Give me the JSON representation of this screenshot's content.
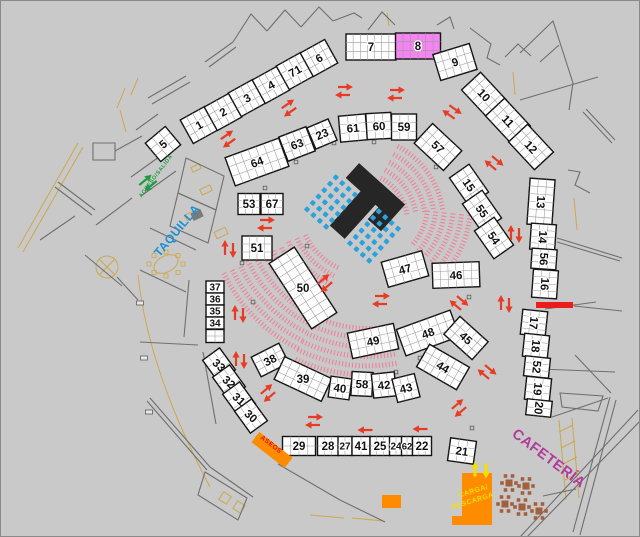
{
  "plan_title": "venue-floor-plan",
  "colors": {
    "bg": "#c9c9c9",
    "border": "#8a8a8a",
    "wall": "#6f6f6f",
    "tan": "#cda84e",
    "booth_fill": "#fdfdfd",
    "booth_stroke": "#141414",
    "grid": "#9b9b9b",
    "number": "#111111",
    "red": "#e83b23",
    "green": "#1f9b40",
    "chair_blue": "#2ba2dc",
    "hatch_pink": "#ef8198",
    "orange": "#ff8c00",
    "yellow": "#f3df00",
    "magenta": "#b23a9c",
    "taquilla_blue": "#1b8fd4",
    "stage_black": "#262626",
    "red_bar": "#ea1c1c",
    "table_brown": "#a2603f",
    "aseos_red": "#dd1111",
    "booth8_pink": "#f285ef"
  },
  "booths": [
    {
      "label": "5",
      "x": 163,
      "y": 144,
      "w": 26,
      "h": 24,
      "a": -40,
      "cols": 3,
      "rows": 3
    },
    {
      "label": "1",
      "x": 199,
      "y": 125,
      "w": 28,
      "h": 27,
      "a": -29,
      "cols": 4,
      "rows": 3
    },
    {
      "label": "2",
      "x": 223,
      "y": 112,
      "w": 28,
      "h": 27,
      "a": -29,
      "cols": 4,
      "rows": 3
    },
    {
      "label": "3",
      "x": 247,
      "y": 98,
      "w": 28,
      "h": 27,
      "a": -29,
      "cols": 4,
      "rows": 3
    },
    {
      "label": "4",
      "x": 271,
      "y": 85,
      "w": 28,
      "h": 27,
      "a": -29,
      "cols": 4,
      "rows": 3
    },
    {
      "label": "71",
      "x": 295,
      "y": 71,
      "w": 28,
      "h": 27,
      "a": -29,
      "cols": 4,
      "rows": 3
    },
    {
      "label": "6",
      "x": 319,
      "y": 58,
      "w": 28,
      "h": 27,
      "a": -29,
      "cols": 4,
      "rows": 3
    },
    {
      "label": "7",
      "x": 371,
      "y": 47,
      "w": 50,
      "h": 26,
      "a": 0,
      "cols": 7,
      "rows": 3
    },
    {
      "label": "8",
      "x": 418,
      "y": 46,
      "w": 45,
      "h": 26,
      "a": 0,
      "cols": 6,
      "rows": 3,
      "fill": "#f285ef"
    },
    {
      "label": "9",
      "x": 455,
      "y": 62,
      "w": 38,
      "h": 27,
      "a": -17,
      "cols": 5,
      "rows": 3
    },
    {
      "label": "10",
      "x": 484,
      "y": 95,
      "w": 38,
      "h": 26,
      "a": 47,
      "cols": 5,
      "rows": 3
    },
    {
      "label": "11",
      "x": 508,
      "y": 121,
      "w": 38,
      "h": 26,
      "a": 47,
      "cols": 5,
      "rows": 3
    },
    {
      "label": "12",
      "x": 531,
      "y": 147,
      "w": 38,
      "h": 26,
      "a": 47,
      "cols": 5,
      "rows": 3
    },
    {
      "label": "13",
      "x": 541,
      "y": 202,
      "w": 25,
      "h": 46,
      "a": 4,
      "cols": 3,
      "rows": 6,
      "lr": 90
    },
    {
      "label": "14",
      "x": 543,
      "y": 237,
      "w": 25,
      "h": 26,
      "a": 4,
      "cols": 3,
      "rows": 4,
      "lr": 90
    },
    {
      "label": "56",
      "x": 544,
      "y": 259,
      "w": 25,
      "h": 20,
      "a": 4,
      "cols": 3,
      "rows": 3,
      "lr": 90
    },
    {
      "label": "16",
      "x": 545,
      "y": 284,
      "w": 25,
      "h": 28,
      "a": 4,
      "cols": 3,
      "rows": 4,
      "lr": 90
    },
    {
      "label": "17",
      "x": 534,
      "y": 323,
      "w": 25,
      "h": 25,
      "a": 6,
      "cols": 3,
      "rows": 4,
      "lr": 90
    },
    {
      "label": "18",
      "x": 536,
      "y": 346,
      "w": 25,
      "h": 23,
      "a": 6,
      "cols": 3,
      "rows": 3,
      "lr": 90
    },
    {
      "label": "52",
      "x": 537,
      "y": 367,
      "w": 25,
      "h": 20,
      "a": 6,
      "cols": 3,
      "rows": 3,
      "lr": 90
    },
    {
      "label": "19",
      "x": 538,
      "y": 389,
      "w": 25,
      "h": 23,
      "a": 6,
      "cols": 3,
      "rows": 3,
      "lr": 90
    },
    {
      "label": "20",
      "x": 539,
      "y": 408,
      "w": 25,
      "h": 16,
      "a": 6,
      "cols": 3,
      "rows": 2,
      "lr": 90
    },
    {
      "label": "64",
      "x": 257,
      "y": 162,
      "w": 57,
      "h": 30,
      "a": -20,
      "cols": 7,
      "rows": 3
    },
    {
      "label": "63",
      "x": 297,
      "y": 144,
      "w": 29,
      "h": 26,
      "a": -21,
      "cols": 4,
      "rows": 3
    },
    {
      "label": "23",
      "x": 322,
      "y": 134,
      "w": 23,
      "h": 23,
      "a": -23,
      "cols": 3,
      "rows": 3
    },
    {
      "label": "61",
      "x": 353,
      "y": 128,
      "w": 27,
      "h": 26,
      "a": -5,
      "cols": 3,
      "rows": 3
    },
    {
      "label": "60",
      "x": 379,
      "y": 126,
      "w": 25,
      "h": 26,
      "a": -3,
      "cols": 3,
      "rows": 3
    },
    {
      "label": "59",
      "x": 404,
      "y": 127,
      "w": 25,
      "h": 26,
      "a": 0,
      "cols": 3,
      "rows": 3
    },
    {
      "label": "57",
      "x": 438,
      "y": 147,
      "w": 40,
      "h": 27,
      "a": 43,
      "cols": 5,
      "rows": 3
    },
    {
      "label": "15",
      "x": 469,
      "y": 185,
      "w": 34,
      "h": 24,
      "a": 55,
      "cols": 4,
      "rows": 3
    },
    {
      "label": "55",
      "x": 482,
      "y": 211,
      "w": 34,
      "h": 24,
      "a": 55,
      "cols": 4,
      "rows": 3
    },
    {
      "label": "54",
      "x": 494,
      "y": 238,
      "w": 34,
      "h": 24,
      "a": 55,
      "cols": 4,
      "rows": 3
    },
    {
      "label": "53",
      "x": 249,
      "y": 204,
      "w": 22,
      "h": 21,
      "a": 0,
      "cols": 3,
      "rows": 3
    },
    {
      "label": "67",
      "x": 272,
      "y": 204,
      "w": 22,
      "h": 21,
      "a": 0,
      "cols": 3,
      "rows": 3
    },
    {
      "label": "51",
      "x": 257,
      "y": 248,
      "w": 30,
      "h": 24,
      "a": 0,
      "cols": 4,
      "rows": 3
    },
    {
      "label": "50",
      "x": 303,
      "y": 288,
      "w": 78,
      "h": 30,
      "a": 57,
      "cols": 9,
      "rows": 3,
      "lr": -57
    },
    {
      "label": "47",
      "x": 405,
      "y": 269,
      "w": 42,
      "h": 26,
      "a": -16,
      "cols": 5,
      "rows": 3
    },
    {
      "label": "46",
      "x": 456,
      "y": 275,
      "w": 47,
      "h": 25,
      "a": -2,
      "cols": 6,
      "rows": 3
    },
    {
      "label": "48",
      "x": 428,
      "y": 333,
      "w": 57,
      "h": 28,
      "a": -20,
      "cols": 7,
      "rows": 3
    },
    {
      "label": "45",
      "x": 466,
      "y": 338,
      "w": 38,
      "h": 24,
      "a": 42,
      "cols": 5,
      "rows": 3
    },
    {
      "label": "44",
      "x": 443,
      "y": 367,
      "w": 46,
      "h": 26,
      "a": 30,
      "cols": 6,
      "rows": 3
    },
    {
      "label": "49",
      "x": 373,
      "y": 341,
      "w": 47,
      "h": 26,
      "a": -12,
      "cols": 6,
      "rows": 3
    },
    {
      "label": "38",
      "x": 270,
      "y": 360,
      "w": 31,
      "h": 22,
      "a": -27,
      "cols": 4,
      "rows": 3
    },
    {
      "label": "39",
      "x": 303,
      "y": 379,
      "w": 52,
      "h": 25,
      "a": 25,
      "cols": 6,
      "rows": 3,
      "lr": -25
    },
    {
      "label": "40",
      "x": 340,
      "y": 388,
      "w": 21,
      "h": 21,
      "a": 8,
      "cols": 3,
      "rows": 3
    },
    {
      "label": "58",
      "x": 362,
      "y": 384,
      "w": 21,
      "h": 24,
      "a": 3,
      "cols": 3,
      "rows": 3
    },
    {
      "label": "42",
      "x": 384,
      "y": 385,
      "w": 23,
      "h": 24,
      "a": -6,
      "cols": 3,
      "rows": 3
    },
    {
      "label": "43",
      "x": 406,
      "y": 388,
      "w": 23,
      "h": 24,
      "a": -14,
      "cols": 3,
      "rows": 3
    },
    {
      "label": "37",
      "x": 215,
      "y": 287,
      "w": 18,
      "h": 12,
      "a": 0,
      "cols": 2,
      "rows": 1,
      "fs": 10
    },
    {
      "label": "36",
      "x": 215,
      "y": 299,
      "w": 18,
      "h": 12,
      "a": 0,
      "cols": 2,
      "rows": 1,
      "fs": 10
    },
    {
      "label": "35",
      "x": 215,
      "y": 311,
      "w": 18,
      "h": 12,
      "a": 0,
      "cols": 2,
      "rows": 1,
      "fs": 10
    },
    {
      "label": "34",
      "x": 215,
      "y": 323,
      "w": 18,
      "h": 12,
      "a": 0,
      "cols": 2,
      "rows": 1,
      "fs": 10
    },
    {
      "label": "",
      "x": 215,
      "y": 336,
      "w": 18,
      "h": 13,
      "a": 0,
      "cols": 2,
      "rows": 2
    },
    {
      "label": "33",
      "x": 219,
      "y": 365,
      "w": 27,
      "h": 21,
      "a": 54,
      "cols": 3,
      "rows": 3,
      "lr": -12
    },
    {
      "label": "32",
      "x": 229,
      "y": 382,
      "w": 27,
      "h": 21,
      "a": 54,
      "cols": 3,
      "rows": 3,
      "lr": -12
    },
    {
      "label": "31",
      "x": 239,
      "y": 399,
      "w": 27,
      "h": 21,
      "a": 54,
      "cols": 3,
      "rows": 3,
      "lr": -12
    },
    {
      "label": "30",
      "x": 251,
      "y": 416,
      "w": 27,
      "h": 21,
      "a": 54,
      "cols": 3,
      "rows": 3,
      "lr": -12
    },
    {
      "label": "29",
      "x": 299,
      "y": 446,
      "w": 33,
      "h": 19,
      "a": 0,
      "cols": 4,
      "rows": 2
    },
    {
      "label": "28",
      "x": 328,
      "y": 446,
      "w": 21,
      "h": 19,
      "a": 0,
      "cols": 3,
      "rows": 2
    },
    {
      "label": "27",
      "x": 345,
      "y": 446,
      "w": 14,
      "h": 19,
      "a": 0,
      "cols": 2,
      "rows": 2,
      "fs": 10
    },
    {
      "label": "41",
      "x": 361,
      "y": 446,
      "w": 18,
      "h": 19,
      "a": 0,
      "cols": 2,
      "rows": 2
    },
    {
      "label": "25",
      "x": 380,
      "y": 446,
      "w": 20,
      "h": 19,
      "a": 0,
      "cols": 3,
      "rows": 2
    },
    {
      "label": "24",
      "x": 396,
      "y": 446,
      "w": 13,
      "h": 19,
      "a": 0,
      "cols": 2,
      "rows": 2,
      "fs": 10
    },
    {
      "label": "62",
      "x": 407,
      "y": 446,
      "w": 11,
      "h": 19,
      "a": 0,
      "cols": 2,
      "rows": 2,
      "fs": 9.5
    },
    {
      "label": "22",
      "x": 422,
      "y": 446,
      "w": 19,
      "h": 19,
      "a": 0,
      "cols": 3,
      "rows": 2
    },
    {
      "label": "21",
      "x": 462,
      "y": 451,
      "w": 26,
      "h": 23,
      "a": 8,
      "cols": 3,
      "rows": 3
    }
  ],
  "zone_labels": [
    {
      "id": "acceso",
      "text": "ACCESO/SALIDA",
      "x": 157,
      "y": 177,
      "a": -53,
      "size": 5.5,
      "color": "#1f9b40"
    },
    {
      "id": "taquilla",
      "text": "TAQUILLA",
      "x": 180,
      "y": 233,
      "a": -50,
      "size": 12,
      "color": "#1b8fd4"
    },
    {
      "id": "aseos",
      "text": "ASEOS",
      "x": 270,
      "y": 446,
      "a": 38,
      "size": 6.5,
      "color": "#dd1111"
    },
    {
      "id": "cafeteria",
      "text": "CAFETERÍA",
      "x": 546,
      "y": 462,
      "a": 37,
      "size": 14.5,
      "color": "#b23a9c"
    },
    {
      "id": "carga-line1",
      "text": "CARGA/",
      "x": 474,
      "y": 493,
      "a": -17,
      "size": 7,
      "color": "#f3df00"
    },
    {
      "id": "carga-line2",
      "text": "DESCARGA",
      "x": 473,
      "y": 503,
      "a": -17,
      "size": 7,
      "color": "#f3df00"
    }
  ],
  "stage": {
    "cx": 368,
    "cy": 198,
    "a": 42,
    "points": "-30,-20 32,-20 32,16 14,16 14,0 10,0 10,46 -10,46 -10,0 -30,0"
  },
  "chair_blocks": [
    {
      "cx": 331,
      "cy": 202,
      "a": 42,
      "cols": 4,
      "rows": 6,
      "pitch": 8.6,
      "size": 4.6
    },
    {
      "cx": 374,
      "cy": 236,
      "a": 42,
      "cols": 4,
      "rows": 6,
      "pitch": 8.6,
      "size": 4.6
    }
  ],
  "hatch_clusters": [
    {
      "cx": 358,
      "cy": 222,
      "r0": 52,
      "r1": 88,
      "a0": -62,
      "a1": -8
    },
    {
      "cx": 368,
      "cy": 205,
      "r0": 62,
      "r1": 105,
      "a0": 6,
      "a1": 42
    },
    {
      "cx": 368,
      "cy": 205,
      "r0": 72,
      "r1": 162,
      "a0": 116,
      "a1": 155
    },
    {
      "cx": 368,
      "cy": 205,
      "r0": 126,
      "r1": 182,
      "a0": 80,
      "a1": 116
    }
  ],
  "arrow_pairs_red": [
    {
      "x": 228,
      "y": 139,
      "a": 35
    },
    {
      "x": 289,
      "y": 108,
      "a": 35
    },
    {
      "x": 344,
      "y": 91,
      "a": 0
    },
    {
      "x": 396,
      "y": 94,
      "a": 0
    },
    {
      "x": 452,
      "y": 112,
      "a": -35
    },
    {
      "x": 494,
      "y": 163,
      "a": -40
    },
    {
      "x": 515,
      "y": 234,
      "a": 90
    },
    {
      "x": 266,
      "y": 224,
      "a": 0
    },
    {
      "x": 229,
      "y": 249,
      "a": 90
    },
    {
      "x": 239,
      "y": 314,
      "a": 90
    },
    {
      "x": 240,
      "y": 360,
      "a": 90
    },
    {
      "x": 268,
      "y": 393,
      "a": 40
    },
    {
      "x": 314,
      "y": 421,
      "a": 0
    },
    {
      "x": 325,
      "y": 283,
      "a": 40
    },
    {
      "x": 381,
      "y": 300,
      "a": 0
    },
    {
      "x": 459,
      "y": 303,
      "a": -40
    },
    {
      "x": 505,
      "y": 304,
      "a": 90
    },
    {
      "x": 487,
      "y": 372,
      "a": -40
    },
    {
      "x": 459,
      "y": 408,
      "a": 40
    }
  ],
  "arrows_red_single": [
    {
      "x": 365,
      "y": 430,
      "a": 180
    },
    {
      "x": 420,
      "y": 429,
      "a": 180
    }
  ],
  "arrow_pair_green": {
    "x": 148,
    "y": 183,
    "a": 40
  },
  "arrows_yellow": [
    {
      "x": 475,
      "y": 469,
      "a": 90
    },
    {
      "x": 486,
      "y": 471,
      "a": 270
    }
  ],
  "orange_areas": {
    "aseos_bar": {
      "cx": 272,
      "cy": 450,
      "w": 42,
      "h": 13,
      "a": 38
    },
    "carga_polygon": "462,473 492,473 492,525 452,525 452,516 462,516",
    "small_rect": {
      "x": 382,
      "y": 495,
      "w": 19,
      "h": 13
    }
  },
  "red_bar": {
    "x": 536,
    "y": 302,
    "w": 37,
    "h": 6
  },
  "cafe_tables": [
    {
      "x": 509,
      "y": 483
    },
    {
      "x": 526,
      "y": 486
    },
    {
      "x": 505,
      "y": 504
    },
    {
      "x": 522,
      "y": 507
    },
    {
      "x": 539,
      "y": 511
    }
  ],
  "columns": [
    [
      265,
      188
    ],
    [
      296,
      162
    ],
    [
      334,
      143
    ],
    [
      374,
      142
    ],
    [
      436,
      167
    ],
    [
      469,
      297
    ],
    [
      420,
      358
    ],
    [
      242,
      263
    ],
    [
      253,
      302
    ],
    [
      472,
      428
    ],
    [
      307,
      246
    ],
    [
      396,
      372
    ]
  ],
  "door_markers": [
    [
      140,
      303
    ],
    [
      144,
      358
    ],
    [
      149,
      412
    ]
  ],
  "walls": [
    "M233,42 L251,14 L267,31",
    "M267,31 L285,10 L301,27",
    "M301,27 L319,7 L333,21",
    "M205,62 L233,42",
    "M209,67 L236,47",
    "M333,21 L354,13 L362,18",
    "M368,30 L382,12 L395,25",
    "M437,25 L450,17 L454,29",
    "M470,28 L491,44 L487,58 L500,65",
    "M505,57 L518,44 L531,56",
    "M520,53 L553,21 L573,83",
    "M540,62 L559,45",
    "M520,100 L598,77",
    "M573,83 L569,110",
    "M583,112 L612,143",
    "M586,109 L615,140",
    "M568,170 L580,172 L575,185 L590,193",
    "M557,238 L622,258",
    "M557,242 L620,261",
    "M574,306 L622,311",
    "M545,309 L596,302",
    "M540,369 L615,372",
    "M560,393 L603,396 L598,411 L562,407 Z",
    "M552,417 L608,398",
    "M575,355 L611,393",
    "M610,397 L573,532",
    "M616,400 L580,535",
    "M638,410 L520,537",
    "M643,418 L527,537",
    "M543,496 L576,489",
    "M148,98 L186,76",
    "M152,104 L190,82",
    "M93,143 L115,143 L115,160 L93,160 Z",
    "M115,151 L142,136",
    "M131,177 L166,152",
    "M141,196 L176,171",
    "M186,158 L224,176 L216,210 L178,193 Z",
    "M178,193 L216,210 L208,243 L170,226 Z",
    "M58,182 L95,210",
    "M55,187 L92,215",
    "M40,240 L75,216",
    "M96,225 L132,198",
    "M85,255 L122,286",
    "M150,228 L196,250",
    "M140,270 L186,292",
    "M189,280 L184,337",
    "M117,277 L138,300",
    "M140,342 L198,345",
    "M203,352 L216,424",
    "M136,130 L158,114",
    "M150,398 L210,467",
    "M147,401 L207,470",
    "M210,467 L253,497",
    "M205,472 L247,498 L238,520 L198,495 Z",
    "M278,464 L340,500 L385,522",
    "M256,436 L290,461"
  ],
  "tan_lines": [
    "M18,248 L78,143",
    "M23,252 L83,147",
    "M138,275 Q148,370 210,487",
    "M117,108 L125,88",
    "M126,132 L120,110",
    "M131,95 L138,78",
    "M387,13 L389,26",
    "M352,518 L384,521",
    "M310,515 L344,518",
    "M513,72 L515,95",
    "M574,198 L577,230",
    "M559,420 L566,500",
    "M572,418 L579,498",
    "M559,432 L573,425",
    "M561,448 L575,441",
    "M563,464 L577,457",
    "M565,480 L579,473"
  ],
  "tan_rects": [
    {
      "x": 196,
      "y": 168,
      "w": 9,
      "h": 5,
      "a": -25
    },
    {
      "x": 206,
      "y": 190,
      "w": 11,
      "h": 6,
      "a": -25
    },
    {
      "x": 190,
      "y": 216,
      "w": 9,
      "h": 6,
      "a": -25
    },
    {
      "x": 221,
      "y": 233,
      "w": 12,
      "h": 7,
      "a": -25
    },
    {
      "x": 225,
      "y": 498,
      "w": 9,
      "h": 9,
      "a": 33
    },
    {
      "x": 239,
      "y": 507,
      "w": 9,
      "h": 9,
      "a": 33
    }
  ],
  "revolving_door": {
    "cx": 107,
    "cy": 267,
    "r": 11
  },
  "oval_table": {
    "cx": 166,
    "cy": 264,
    "rx": 13,
    "ry": 8,
    "a": -28
  },
  "dark_desk": {
    "x": 197,
    "y": 215,
    "w": 11,
    "h": 8,
    "a": -25
  }
}
